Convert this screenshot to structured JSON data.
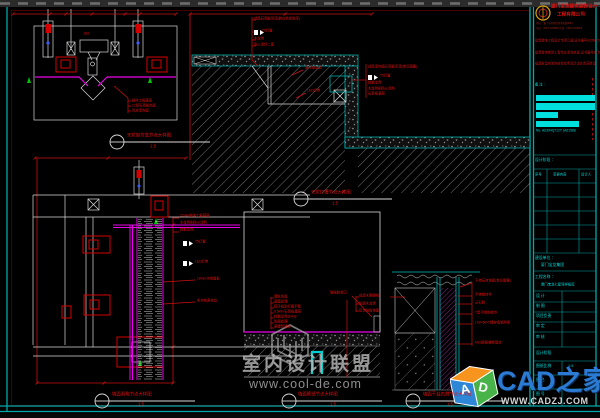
{
  "colors": {
    "annotation_red": "#e81010",
    "frame_cyan": "#00a8a8",
    "magenta": "#e800e8",
    "highlight_cyan": "#00dede",
    "logo_blue": "#2b7ad4"
  },
  "callouts": [
    {
      "title": "天花窗帘盒节点大样图",
      "scale": "1:5"
    },
    {
      "title": "天花灯槽节点大样图",
      "scale": "1:5"
    },
    {
      "title": "墙面阴角节点大样图",
      "scale": "1:5"
    },
    {
      "title": "墙面壁纸节点大样图",
      "scale": "1:5"
    },
    {
      "title": "墙面干挂石材节点大样图",
      "scale": "1:5"
    }
  ],
  "d1": {
    "dim": "800",
    "lines": [
      "细木工板基层",
      "12厚石膏板饰面",
      "乳胶漆饰面"
    ]
  },
  "d2": {
    "top": [
      "成品石膏板吊顶(刷白色乳胶漆)",
      "T5灯管",
      "木龙骨",
      "防火涂料二度"
    ],
    "curtain": "窗帘盒轨道",
    "led": "LED灯带",
    "right": [
      "成品漆饰面石膏板吊顶(参见图集)",
      "T5灯管",
      "轻钢龙骨",
      "木龙骨刷防火涂料",
      "石膏板基层"
    ]
  },
  "d3": {
    "right": [
      "12mm细木工板基层",
      "木龙骨刷防火涂料",
      "轻钢龙骨"
    ],
    "lamp1": "T5灯管",
    "lamp2": "LED灯带",
    "strip1": "18mm木饰面板",
    "strip2": "实木线条收边"
  },
  "d4": {
    "left": [
      "墙纸饰面",
      "基膜处理",
      "腻子批刮打磨平整",
      "9.5mm石膏板基层",
      "轻钢龙骨@400",
      "防潮处理",
      "原建筑墙体"
    ],
    "tag": "玻璃胶收口",
    "right": [
      "成品木踢脚线",
      "防腐木龙骨",
      "复合地板饰面"
    ]
  },
  "d5": {
    "right": [
      "干挂石材饰面(参见图集)",
      "不锈钢挂件",
      "云石胶",
      "T型不锈钢挂件",
      "L50×50×5镀锌角钢骨架",
      "M10膨胀螺栓固定"
    ]
  },
  "title_block": {
    "company1": "厦门宝龙建筑装饰设计",
    "company2": "工程有限公司",
    "addr1": "地址：厦门市思明区湖滨南路888号",
    "addr2": "电话：0592-5205888  传真：0592-5205889",
    "cert1": "建筑装饰工程设计专项乙级 证书编号A235005888",
    "cert2": "建筑装饰装修工程专业承包贰级 证书编号B2350059",
    "cert3": "福建省室内装饰协会优秀设计企业会员单位",
    "note_label": "备 注 ：",
    "no": "No. A0394Q712Y (A01568",
    "stage_label": "设计阶段 ：",
    "col1": "序号",
    "col2": "变更内容",
    "col3": "设计人",
    "client_label": "建设单位 ：",
    "client": "厦门宝龙集团",
    "project_label": "工程名称 ：",
    "project": "厦门宝龙七星湾样板房",
    "f1": "设  计",
    "f2": "制  图",
    "f3": "项目负责",
    "f4": "审  定",
    "f5": "审  核",
    "f6": "设计阶段",
    "f7": "图纸比例",
    "scale_val": "1:5",
    "f8": "图  名",
    "f9": "图  号"
  },
  "watermark": {
    "name": "室内设计联盟",
    "url": "www.cool-de.com"
  },
  "cad_logo": {
    "name": "CAD之家",
    "url": "WWW.CADZJ.COM",
    "letter_a": "A",
    "letter_d": "D"
  }
}
